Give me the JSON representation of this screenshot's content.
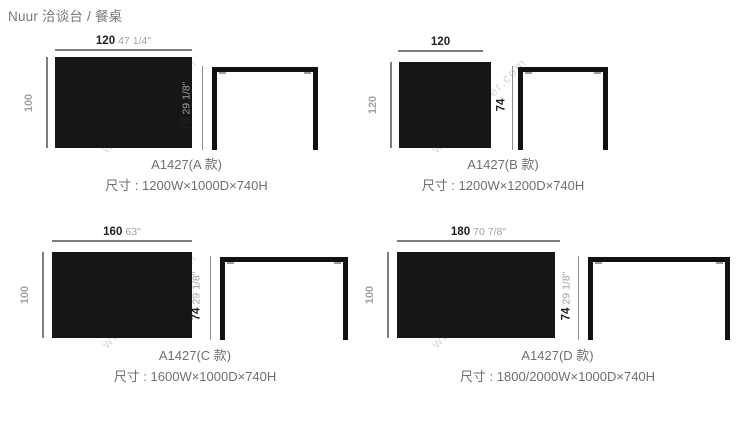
{
  "page": {
    "title": "Nuur 洽谈台 / 餐桌"
  },
  "watermark": {
    "text": "www.onsuner.com"
  },
  "products": [
    {
      "id": "A",
      "name": "A1427(A 款)",
      "size": "尺寸 : 1200W×1000D×740H",
      "width_cm": "120",
      "width_in": "47 1/4\"",
      "depth_cm": "100",
      "height_cm": "74",
      "height_in": "29 1/8\""
    },
    {
      "id": "B",
      "name": "A1427(B 款)",
      "size": "尺寸 : 1200W×1200D×740H",
      "width_cm": "120",
      "width_in": "",
      "depth_cm": "120",
      "height_cm": "74",
      "height_in": ""
    },
    {
      "id": "C",
      "name": "A1427(C 款)",
      "size": "尺寸 : 1600W×1000D×740H",
      "width_cm": "160",
      "width_in": "63\"",
      "depth_cm": "100",
      "height_cm": "74",
      "height_in": "29 1/8\""
    },
    {
      "id": "D",
      "name": "A1427(D 款)",
      "size": "尺寸 : 1800/2000W×1000D×740H",
      "width_cm": "180",
      "width_in": "70 7/8\"",
      "depth_cm": "100",
      "height_cm": "74",
      "height_in": "29 1/8\""
    }
  ]
}
